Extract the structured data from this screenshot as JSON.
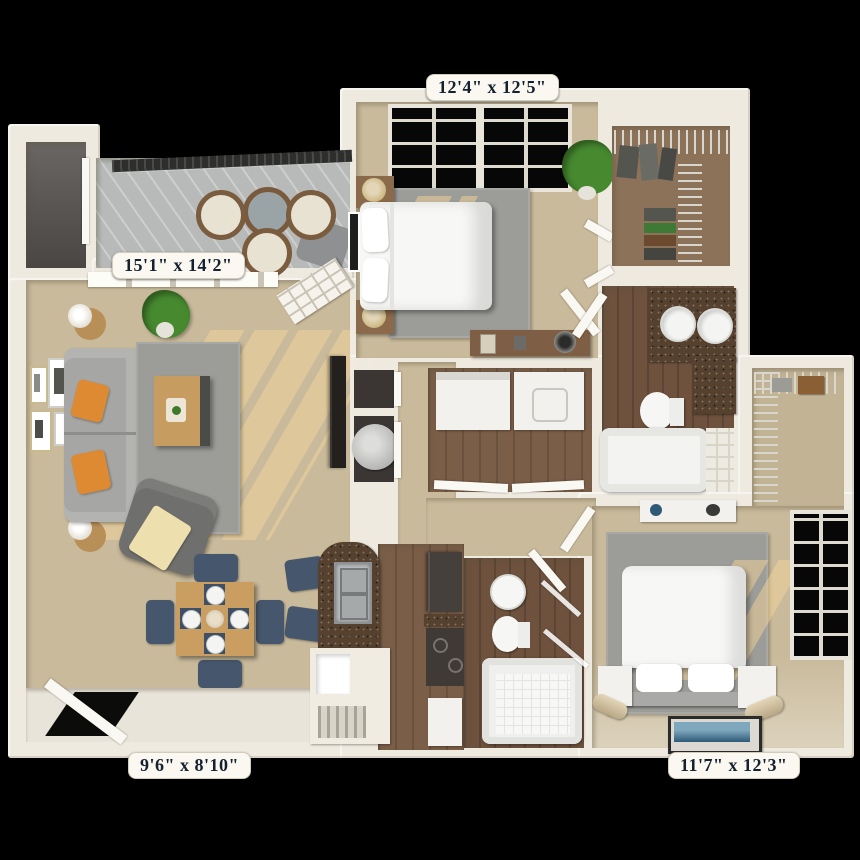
{
  "title": "3D apartment floor plan",
  "labels": {
    "bedroom1": "12'4\" x 12'5\"",
    "living": "15'1\" x 14'2\"",
    "entry": "9'6\" x 8'10\"",
    "bedroom2": "11'7\" x 12'3\""
  },
  "rooms": [
    {
      "name": "balcony"
    },
    {
      "name": "storage-closet"
    },
    {
      "name": "living-room"
    },
    {
      "name": "dining-area"
    },
    {
      "name": "entry"
    },
    {
      "name": "kitchen"
    },
    {
      "name": "laundry"
    },
    {
      "name": "bedroom-1"
    },
    {
      "name": "walk-in-closet-1"
    },
    {
      "name": "bathroom-1"
    },
    {
      "name": "walk-in-closet-2"
    },
    {
      "name": "bathroom-2"
    },
    {
      "name": "bedroom-2"
    },
    {
      "name": "hallway"
    },
    {
      "name": "utility-closet"
    }
  ],
  "colors": {
    "background": "#000000",
    "wall": "#EFEAE0",
    "carpet": "#C9BA9B",
    "wood_floor": "#7B5E48",
    "rug": "#9C9C98",
    "sofa": "#A6A6A4",
    "accent_pillow": "#DD8A33",
    "dining_chair": "#46566C",
    "granite": "#55412E",
    "label_text": "#14222F",
    "label_bg": "#FBF8F1",
    "plant": "#46892F"
  }
}
